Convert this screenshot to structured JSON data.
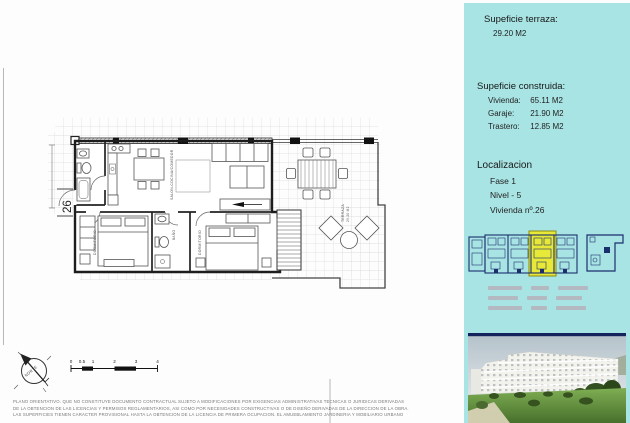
{
  "sidebar": {
    "terrace_title": "Supeficie terraza:",
    "terrace_value": "29.20 M2",
    "built_title": "Supeficie construida:",
    "built_rows": [
      {
        "label": "Vivienda:",
        "value": "65.11 M2"
      },
      {
        "label": "Garaje:",
        "value": "21.90 M2"
      },
      {
        "label": "Trastero:",
        "value": "12.85 M2"
      }
    ],
    "location_title": "Localizacion",
    "location_rows": [
      "Fase 1",
      "Nivel - 5",
      "Vivienda nº.26"
    ]
  },
  "plan": {
    "unit_number": "26",
    "room_labels": {
      "living": "SALON-COCINA/COMEDOR",
      "bedroom1": "DORMITORIO",
      "bathroom": "BAÑO",
      "bedroom2": "DORMITORIO",
      "terrace": "TERRAZA",
      "terrace_area": "29.20 M2"
    },
    "compass_label": "NORTE",
    "scale_ticks": [
      "0",
      "0.5",
      "1",
      "2",
      "3",
      "4"
    ]
  },
  "disclaimer": {
    "line1": "PLANO ORIENTATIVO. QUE NO CONSTITUYE DOCUMENTO CONTRACTUAL SUJETO A MODIFICACIONES POR EXIGENCIAS ADMINISTRATIVAS TECNICAS O JURIDICAS DERIVADAS",
    "line2": "DE LA OBTENCION DE LAS LICENCIAS Y PERMISOS REGLAMENTARIOS, ASI COMO POR NECESIDADES CONSTRUCTIVAS O DE DISEÑO DERIVADAS DE LA DIRECCION DE LA OBRA.",
    "line3": "LAS SUPERFICIES TIENEN CARACTER PROVISIONAL HASTA LA OBTENCION DE LA LICENCIA DE PRIMERA OCUPACION. EL AMUEBLAMIENTO JARDINERIA Y MOBILIARIO URBANO"
  },
  "colors": {
    "sidebar_bg": "#a9e4e4",
    "map_outline": "#1b2f6e",
    "map_highlight": "#e8e838"
  }
}
